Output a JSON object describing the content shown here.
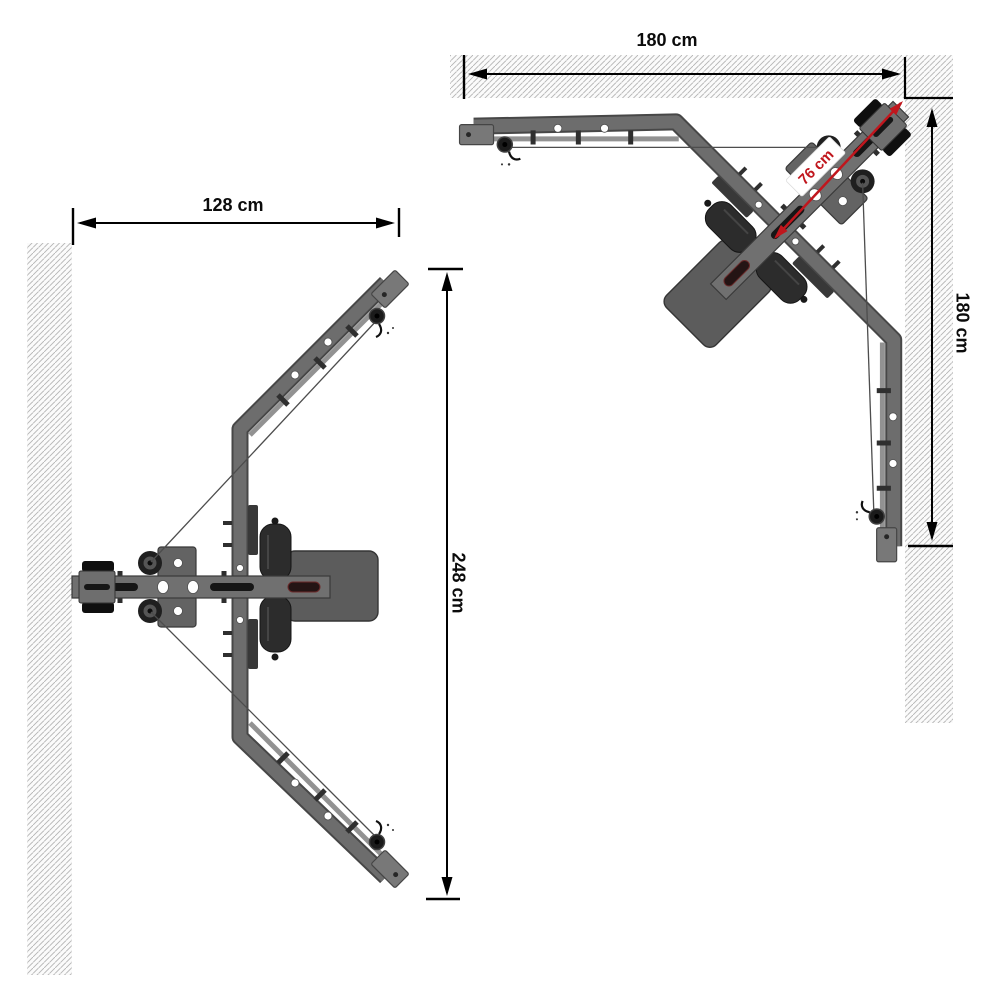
{
  "colors": {
    "background": "#ffffff",
    "wall_hatch": "#b5b5b5",
    "machine_gray": "#6d6d6d",
    "machine_dark": "#2c2c2c",
    "dimension": "#000000",
    "accent_red": "#c0161d"
  },
  "left_view": {
    "width_label": "128 cm",
    "depth_label": "248 cm"
  },
  "right_view": {
    "top_width_label": "180 cm",
    "side_depth_label": "180 cm",
    "corner_clearance_label": "76 cm"
  }
}
